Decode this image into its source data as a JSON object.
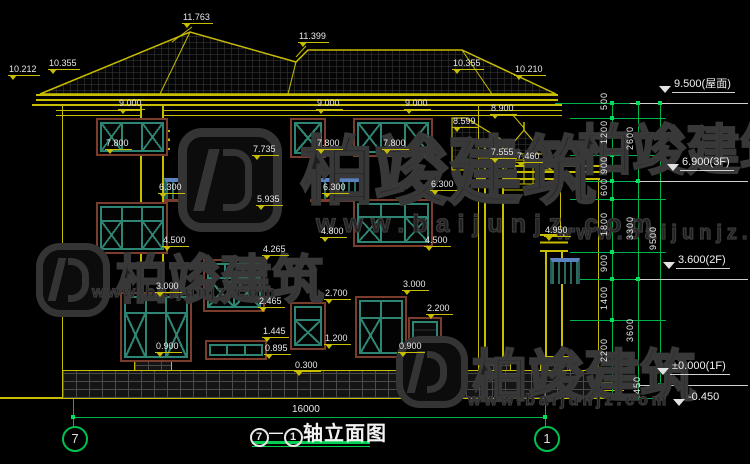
{
  "watermark": {
    "brand": "柏竣建筑",
    "url": "www.baijunjz.com"
  },
  "labels": [
    "11.763",
    "11.399",
    "10.212",
    "10.355",
    "10.355",
    "10.210",
    "9.000",
    "9.000",
    "9.000",
    "8.900",
    "8.599",
    "7.800",
    "7.800",
    "7.800",
    "7.735",
    "7.555",
    "7.460",
    "6.300",
    "6.300",
    "6.300",
    "5.935",
    "4.950",
    "4.800",
    "4.500",
    "4.500",
    "4.265",
    "3.000",
    "3.000",
    "2.700",
    "2.465",
    "2.200",
    "1.445",
    "1.200",
    "0.895",
    "0.900",
    "0.900",
    "0.300"
  ],
  "chain": {
    "c1": [
      "500",
      "1200",
      "900",
      "600",
      "1800",
      "900",
      "1400",
      "2200"
    ],
    "c2": [
      "2600",
      "3300",
      "3600"
    ],
    "c450": "450",
    "c3": "9500"
  },
  "markers": [
    "9.500(屋面)",
    "6.900(3F)",
    "3.600(2F)",
    "±0.000(1F)",
    "-0.450"
  ],
  "bottom": {
    "overall": "16000",
    "bubble_left": "7",
    "bubble_right": "1",
    "title_axis_left": "7",
    "title_axis_right": "1",
    "dash": "—",
    "title": "轴立面图"
  }
}
